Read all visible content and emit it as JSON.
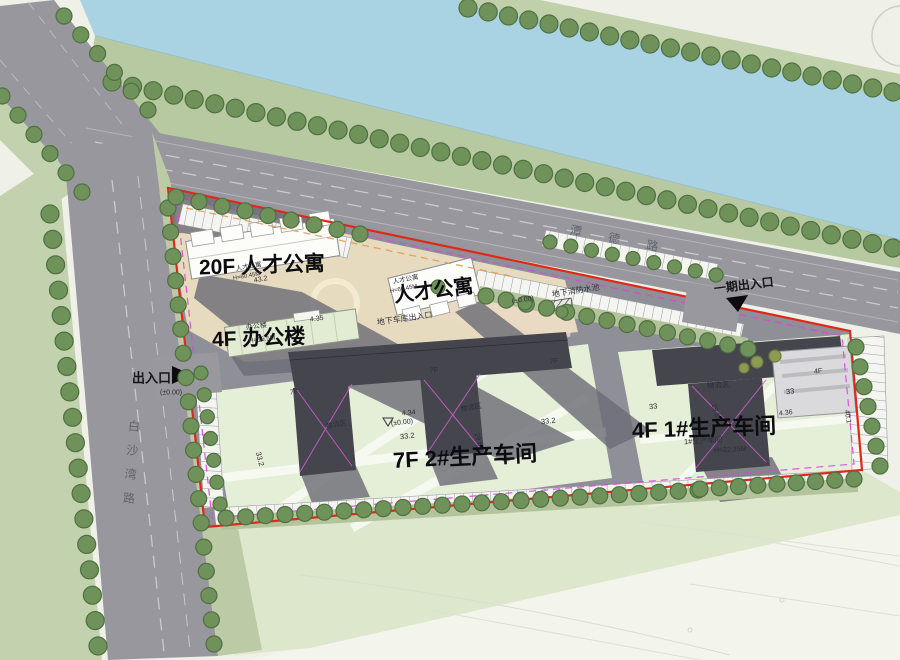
{
  "plan_meta": {
    "type": "site-plan",
    "boundary_color": "#e02818",
    "inner_boundary_color": "#dd44dd",
    "water_color": "#a9d3e3",
    "road_color": "#97979d",
    "parcel_green": "#e5eed7",
    "plaza_beige": "#e6dabf",
    "building_dark": "#45454e",
    "tree_green": "#6f925a"
  },
  "big_labels": [
    {
      "name": "label-20f-apartment",
      "text": "20F 人才公寓",
      "x": 199,
      "y": 268,
      "size": 21,
      "rot": -2
    },
    {
      "name": "label-apartment",
      "text": "人才公寓",
      "x": 394,
      "y": 296,
      "size": 20,
      "rot": -7
    },
    {
      "name": "label-4f-office",
      "text": "4F  办公楼",
      "x": 212,
      "y": 340,
      "size": 21,
      "rot": -2
    },
    {
      "name": "label-7f-workshop2",
      "text": "7F  2#生产车间",
      "x": 393,
      "y": 461,
      "size": 22,
      "rot": -3
    },
    {
      "name": "label-4f-workshop1",
      "text": "4F  1#生产车间",
      "x": 632,
      "y": 431,
      "size": 22,
      "rot": -2
    }
  ],
  "entrance_labels": [
    {
      "name": "label-west-entrance",
      "text": "出入口",
      "x": 132,
      "y": 378,
      "size": 13,
      "rot": 0
    },
    {
      "name": "label-phase1-entrance",
      "text": "一期出入口",
      "x": 714,
      "y": 289,
      "size": 12,
      "rot": -7
    }
  ],
  "road_labels": [
    {
      "name": "road-name-baishawan",
      "text": "白沙湾路",
      "x": 128,
      "y": 420,
      "size": 12,
      "rot": 4,
      "vertical": true,
      "spacing": 12
    },
    {
      "name": "road-name-top",
      "text": "潭德路",
      "x": 570,
      "y": 230,
      "size": 12,
      "rot": 11,
      "spacing": 27
    }
  ],
  "small_labels": [
    {
      "name": "ann-apartment1-name",
      "text": "人才公寓",
      "x": 236,
      "y": 270,
      "size": 6.5,
      "rot": -10
    },
    {
      "name": "ann-apartment1-height",
      "text": "H=60.45M",
      "x": 233,
      "y": 279,
      "size": 6,
      "rot": -10
    },
    {
      "name": "ann-apartment2-name",
      "text": "人才公寓",
      "x": 393,
      "y": 283,
      "size": 6.5,
      "rot": -11
    },
    {
      "name": "ann-apartment2-height",
      "text": "H=60.45M",
      "x": 390,
      "y": 292,
      "size": 6,
      "rot": -11
    },
    {
      "name": "ann-office-name",
      "text": "办公楼",
      "x": 246,
      "y": 328,
      "size": 7,
      "rot": -7
    },
    {
      "name": "ann-office-height",
      "text": "H=16.5M",
      "x": 249,
      "y": 342,
      "size": 6.5,
      "rot": -7
    },
    {
      "name": "ann-garage-entrance",
      "text": "地下车库出入口",
      "x": 377,
      "y": 323,
      "size": 8,
      "rot": -8
    },
    {
      "name": "ann-fire-pool",
      "text": "地下消防水池",
      "x": 552,
      "y": 295,
      "size": 8,
      "rot": -9
    },
    {
      "name": "ann-level-fire-pool",
      "text": "(±0.00)",
      "x": 512,
      "y": 302,
      "size": 7,
      "rot": -9
    },
    {
      "name": "ann-level-west",
      "text": "(±0.00)",
      "x": 160,
      "y": 393,
      "size": 7,
      "rot": 0
    },
    {
      "name": "ann-dim-434",
      "text": "4.34",
      "x": 402,
      "y": 414,
      "size": 7,
      "rot": -6
    },
    {
      "name": "ann-level-parcel2",
      "text": "(±0.00)",
      "x": 391,
      "y": 424,
      "size": 7,
      "rot": -6
    },
    {
      "name": "ann-dim-332-a",
      "text": "33.2",
      "x": 400,
      "y": 437,
      "size": 7.5,
      "rot": -6
    },
    {
      "name": "ann-dim-332-b",
      "text": "33.2",
      "x": 541,
      "y": 422,
      "size": 7.5,
      "rot": -6
    },
    {
      "name": "ann-dim-332-c",
      "text": "33.2",
      "x": 258,
      "y": 452,
      "size": 7.5,
      "rot": 76
    },
    {
      "name": "ann-logistics-a",
      "text": "物流区",
      "x": 326,
      "y": 427,
      "size": 7,
      "rot": -10
    },
    {
      "name": "ann-logistics-b",
      "text": "物流区",
      "x": 461,
      "y": 410,
      "size": 7,
      "rot": -10
    },
    {
      "name": "ann-logistics-c",
      "text": "物流区",
      "x": 707,
      "y": 386,
      "size": 7.5,
      "rot": -4
    },
    {
      "name": "ann-workshop1-name",
      "text": "1#生产车间",
      "x": 684,
      "y": 442,
      "size": 7.5,
      "rot": -3
    },
    {
      "name": "ann-workshop1-height",
      "text": "H=22.35M",
      "x": 714,
      "y": 451,
      "size": 7,
      "rot": -3
    },
    {
      "name": "ann-dim-33-a",
      "text": "33",
      "x": 649,
      "y": 407,
      "size": 7.5,
      "rot": -6
    },
    {
      "name": "ann-dim-33-b",
      "text": "33",
      "x": 786,
      "y": 392,
      "size": 7.5,
      "rot": -6
    },
    {
      "name": "ann-dim-298-a",
      "text": "29.8",
      "x": 713,
      "y": 404,
      "size": 7,
      "rot": 74
    },
    {
      "name": "ann-dim-298-b",
      "text": "29.8",
      "x": 476,
      "y": 433,
      "size": 7,
      "rot": 74
    },
    {
      "name": "ann-dim-436",
      "text": "4.36",
      "x": 779,
      "y": 414,
      "size": 7,
      "rot": -6
    },
    {
      "name": "ann-dim-401",
      "text": "40.1",
      "x": 846,
      "y": 410,
      "size": 7,
      "rot": 80
    },
    {
      "name": "ann-dim-432",
      "text": "43.2",
      "x": 254,
      "y": 281,
      "size": 7,
      "rot": -10
    },
    {
      "name": "ann-dim-435",
      "text": "4.35",
      "x": 310,
      "y": 320,
      "size": 7,
      "rot": -7
    },
    {
      "name": "ann-floor-7f-a",
      "text": "7F",
      "x": 290,
      "y": 393,
      "size": 7,
      "rot": -4
    },
    {
      "name": "ann-floor-7f-b",
      "text": "7F",
      "x": 430,
      "y": 371,
      "size": 7,
      "rot": -4
    },
    {
      "name": "ann-floor-7f-c",
      "text": "7F",
      "x": 550,
      "y": 362,
      "size": 7,
      "rot": -4
    },
    {
      "name": "ann-floor-4f",
      "text": "4F",
      "x": 814,
      "y": 372,
      "size": 7,
      "rot": -4
    }
  ]
}
